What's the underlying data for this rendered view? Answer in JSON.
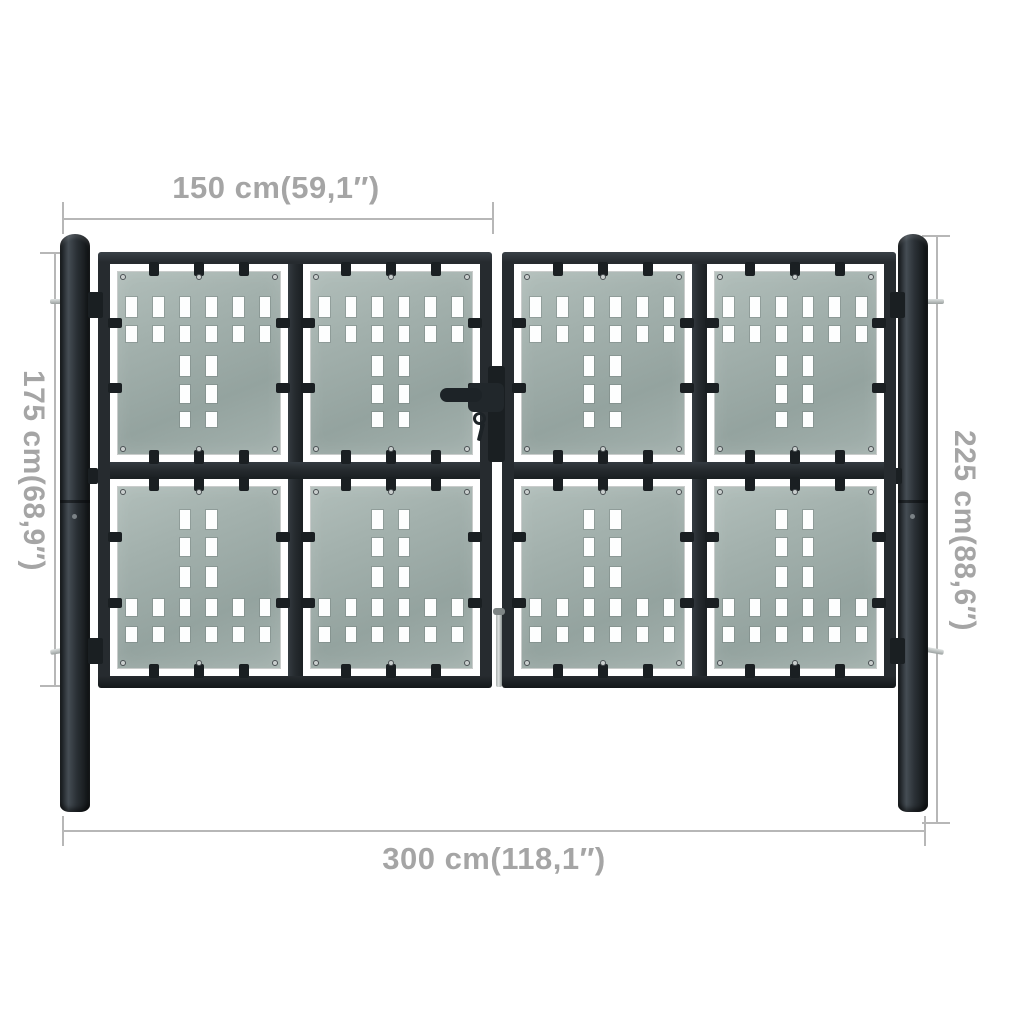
{
  "dimensions": {
    "top": {
      "label": "150 cm(59,1″)"
    },
    "left": {
      "label": "175 cm(68,9″)"
    },
    "right": {
      "label": "225 cm(88,6″)"
    },
    "bottom": {
      "label": "300 cm(118,1″)"
    }
  },
  "colors": {
    "background": "#ffffff",
    "frame": "#262b2f",
    "frame_dark": "#1a1f22",
    "frame_light": "#3b434a",
    "panel": "#a3b1ad",
    "panel_light": "#b1beba",
    "panel_dark": "#94a39f",
    "hole": "#fdfefe",
    "dim_line": "#b7b7b7",
    "dim_text": "#a5a5a5",
    "metal": "#c9cecd",
    "metal_dark": "#8e9594"
  },
  "gate": {
    "leaf_count": 2,
    "panels_per_leaf": 4,
    "panel": {
      "hole_column_centers_pct": [
        8.5,
        25,
        41.5,
        58,
        74.5,
        91
      ],
      "mid_column_indexes": [
        2,
        3
      ],
      "hole_width_pct": 6.6,
      "patterns": {
        "top": [
          {
            "cols": "all",
            "y_pct": 14,
            "h_pct": 11
          },
          {
            "cols": "all",
            "y_pct": 30,
            "h_pct": 8.5
          },
          {
            "cols": "mid",
            "y_pct": 46.5,
            "h_pct": 11
          },
          {
            "cols": "mid",
            "y_pct": 62.5,
            "h_pct": 9.5
          },
          {
            "cols": "mid",
            "y_pct": 77,
            "h_pct": 8.5
          }
        ],
        "bottom": [
          {
            "cols": "mid",
            "y_pct": 13,
            "h_pct": 10.5
          },
          {
            "cols": "mid",
            "y_pct": 28.5,
            "h_pct": 10
          },
          {
            "cols": "mid",
            "y_pct": 44.5,
            "h_pct": 11
          },
          {
            "cols": "all",
            "y_pct": 62,
            "h_pct": 9.5
          },
          {
            "cols": "all",
            "y_pct": 77.5,
            "h_pct": 8
          }
        ]
      }
    }
  }
}
